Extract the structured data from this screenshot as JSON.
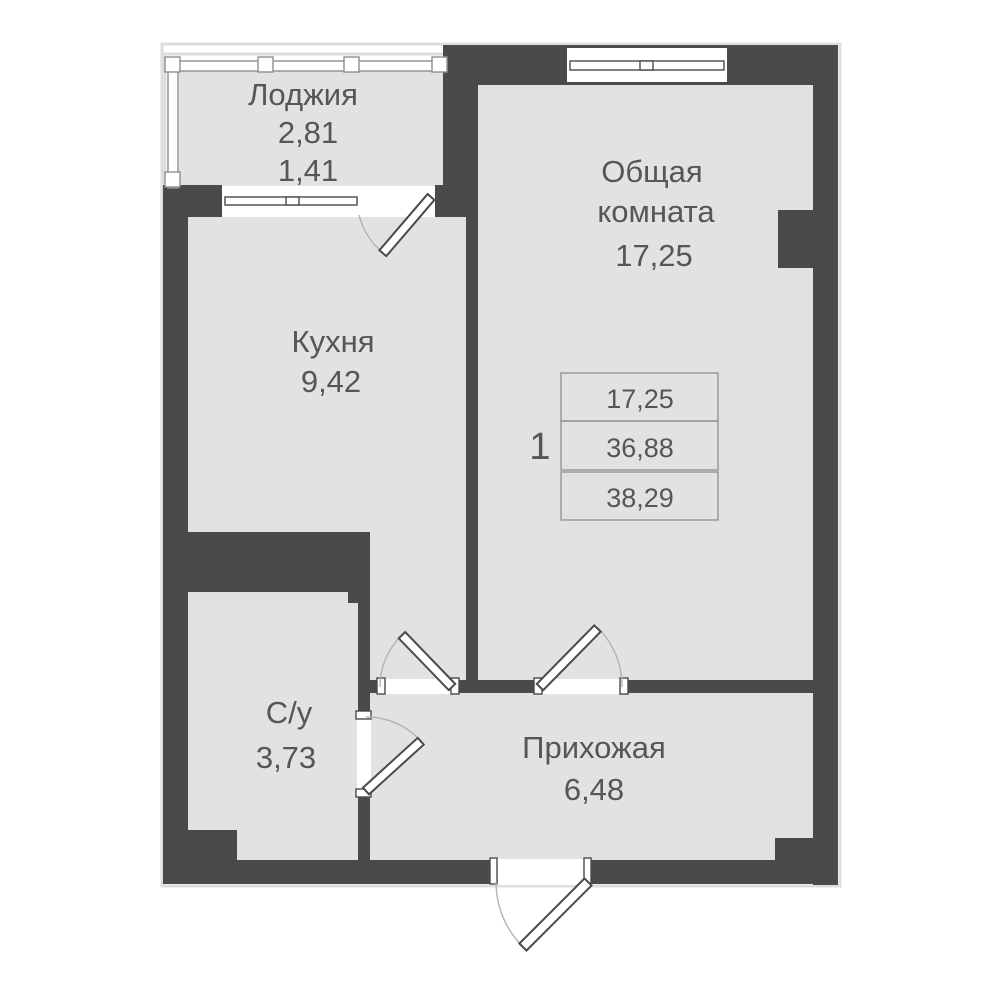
{
  "colors": {
    "wall": "#4a4a4a",
    "floor": "#e2e2e2",
    "window_frame": "#4a4a4a",
    "door_swing_arc": "#b3b3b3",
    "text": "#565656",
    "table_border": "#9a9a9a"
  },
  "rooms": {
    "loggia": {
      "name": "Лоджия",
      "area_total": "2,81",
      "area_reduced": "1,41"
    },
    "living_room": {
      "name_line1": "Общая",
      "name_line2": "комната",
      "area": "17,25"
    },
    "kitchen": {
      "name": "Кухня",
      "area": "9,42"
    },
    "bathroom": {
      "name": "С/у",
      "area": "3,73"
    },
    "hallway": {
      "name": "Прихожая",
      "area": "6,48"
    }
  },
  "info_table": {
    "apartment_number": "1",
    "rows": [
      "17,25",
      "36,88",
      "38,29"
    ]
  }
}
